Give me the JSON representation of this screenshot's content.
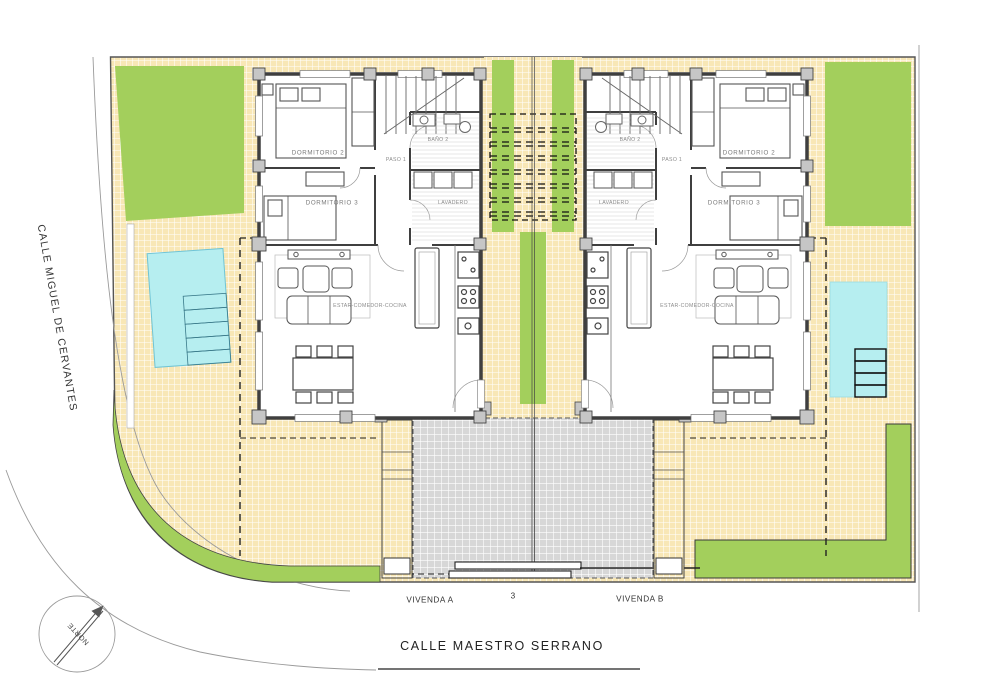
{
  "streets": {
    "left_label": "CALLE MIGUEL DE CERVANTES",
    "bottom_label": "CALLE MAESTRO SERRANO"
  },
  "site": {
    "plot_number": "3"
  },
  "compass": {
    "label": "NORTE"
  },
  "houses": {
    "a": {
      "name_label": "VIVENDA A",
      "rooms": {
        "dormitorio2": "DORMITORIO 2",
        "dormitorio3": "DORMITORIO 3",
        "bano2": "BAÑO 2",
        "paso1": "PASO 1",
        "lavadero": "LAVADERO",
        "estar": "ESTAR-COMEDOR-COCINA"
      }
    },
    "b": {
      "name_label": "VIVENDA B",
      "rooms": {
        "dormitorio2": "DORMITORIO 2",
        "dormitorio3": "DORMITORIO 3",
        "bano2": "BAÑO 2",
        "paso1": "PASO 1",
        "lavadero": "LAVADERO",
        "estar": "ESTAR-COMEDOR-COCINA"
      }
    }
  },
  "legend_colors": {
    "lawn_green": "#a3cf5c",
    "terrace_tile": "#f8e7b6",
    "pool_water": "#b6eef0",
    "driveway_gray": "#d7d7d7",
    "wall_dark": "#3f3f3f"
  }
}
